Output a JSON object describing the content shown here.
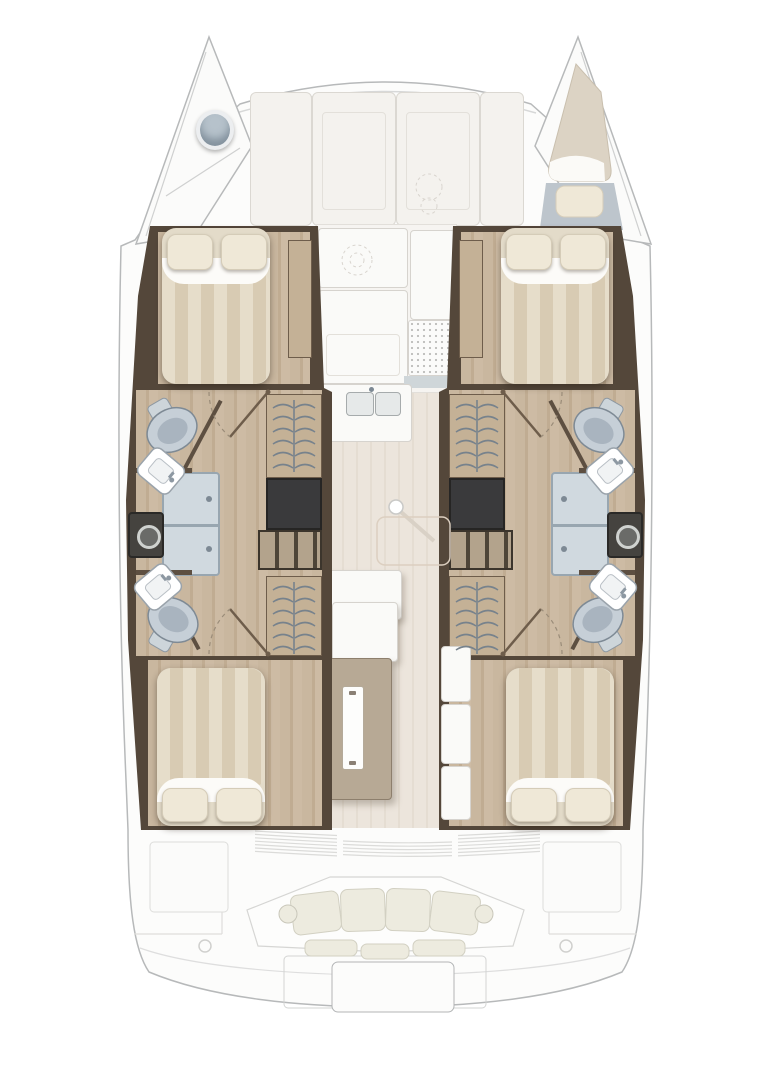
{
  "meta": {
    "kind": "catamaran-yacht-floor-plan",
    "view": "top-down",
    "visible_text": "none"
  },
  "palette": {
    "bg": "#ffffff",
    "hull_fill": "#fcfcfb",
    "hull_line": "#b7b9ba",
    "hull_line_soft": "#d7d8d8",
    "deck_panel": "#f4f2ee",
    "deck_panel_line": "#dbd8d2",
    "wall_dark": "#54473a",
    "floor_wood": "#c9b79f",
    "bed_stripe_a": "#e6ddca",
    "bed_stripe_b": "#d8cbb3",
    "pillow": "#efe8d7",
    "shower_pan": "#d0d9df",
    "void_dark": "#3a3a3c",
    "cushion": "#edebdf",
    "fixture_metal": "#c6cfd7",
    "berth_beige": "#dcd3c4",
    "bow_floor": "#bdc5cc"
  },
  "layout": {
    "hulls": [
      "port",
      "starboard"
    ],
    "symmetry": "mirrored-about-centerline",
    "counts": {
      "cabins": 4,
      "heads": 4,
      "showers": 2,
      "double-beds": 4,
      "hanging-lockers": 4,
      "companionway-stairs": 2,
      "washers": 2
    },
    "zones": {
      "bow_port": [
        "anchor-locker",
        "deck-hatch"
      ],
      "bow_starboard": [
        "forepeak-berth",
        "pillow"
      ],
      "foredeck_lounge": [
        "sun-pad-panels",
        "emblem-mark"
      ],
      "cabin_forward_port": [
        "double-bed",
        "two-pillows",
        "wardrobe-strip"
      ],
      "head_forward_port": [
        "toilet",
        "sink",
        "shower"
      ],
      "companionway_port": [
        "stairs",
        "hanging-locker",
        "hanging-locker",
        "washer"
      ],
      "head_aft_port": [
        "toilet",
        "sink"
      ],
      "cabin_aft_port": [
        "double-bed",
        "two-pillows"
      ],
      "cabin_forward_starboard": [
        "double-bed",
        "two-pillows",
        "wardrobe-strip"
      ],
      "head_forward_starboard": [
        "toilet",
        "sink",
        "shower"
      ],
      "companionway_starboard": [
        "stairs",
        "hanging-locker",
        "hanging-locker",
        "washer"
      ],
      "head_aft_starboard": [
        "toilet",
        "sink"
      ],
      "cabin_aft_starboard": [
        "double-bed",
        "two-pillows"
      ],
      "saloon": [
        "galley-counter",
        "double-sink",
        "stove-grate",
        "tall-cabinet",
        "mast-post",
        "folding-table-outline",
        "aft-counter",
        "aft-cabinet",
        "sliding-door",
        "shelf-column"
      ],
      "aft_bulkhead": [
        "louvered-door-bands"
      ],
      "cockpit": [
        "curved-bench",
        "back-cushions",
        "seat-cushions",
        "side-lockers",
        "deck-rings",
        "transom",
        "swim-platform"
      ]
    }
  }
}
